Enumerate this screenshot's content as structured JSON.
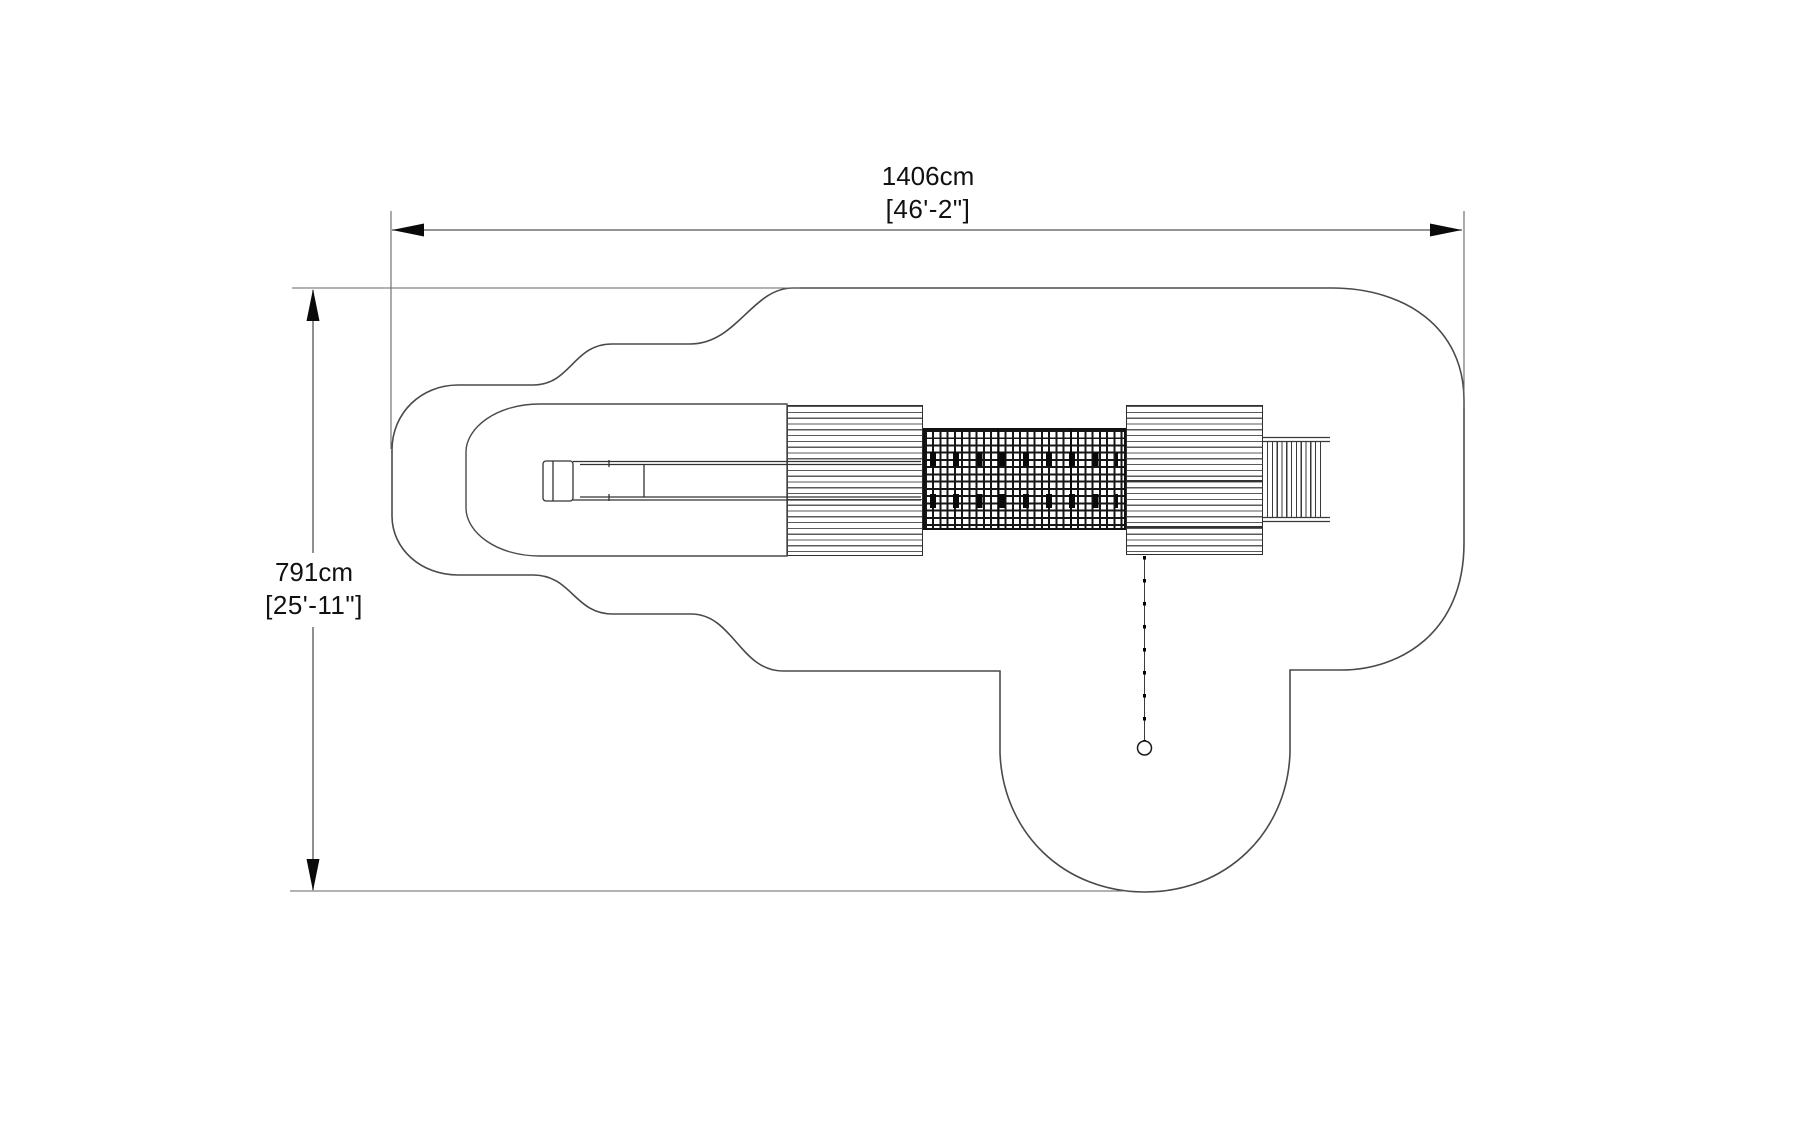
{
  "dimensions": {
    "width": {
      "metric": "1406cm",
      "imperial": "[46'-2\"]"
    },
    "height": {
      "metric": "791cm",
      "imperial": "[25'-11\"]"
    }
  },
  "colors": {
    "background": "#ffffff",
    "boundary_line": "#4a4a4a",
    "equipment_line": "#333333",
    "dimension_line": "#555555",
    "extension_line": "#666666",
    "arrow": "#0a0a0a",
    "net_line": "#101010",
    "text": "#111111"
  },
  "patterns": {
    "left_ramp_stripe_count": 26,
    "right_ramp_stripe_count": 26,
    "net_link_rows": 2,
    "net_links_per_row": 9,
    "ladder_rung_count": 12,
    "drop_line_dot_count": 8
  }
}
